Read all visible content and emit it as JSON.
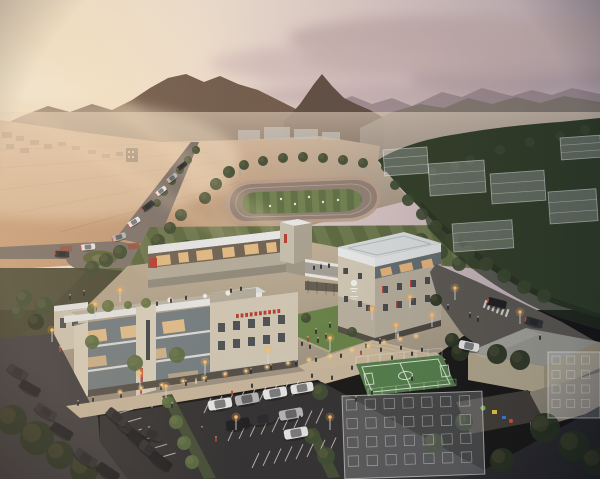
{
  "scene": {
    "type": "architectural-aerial-rendering",
    "time_of_day": "dusk",
    "description": "Aerial dusk rendering of a modern low-rise campus of three connected stone-and-glass buildings with a rooftop garden terrace, central courtyard lawn, futsal court, parking lot, roundabout boulevard, running-track field, translucent planned buildings, forested hills and sunset mountains"
  },
  "palette": {
    "mtn_left": "#6e5849",
    "mtn_dark": "#5b4a40",
    "mtn_far": "#99878d",
    "mtn_mid": "#81776f",
    "forest": "#2a3823",
    "forest_dark": "#1f2b1b",
    "slope": "#41422e",
    "island": "#5a6138",
    "lawn": "#5e6c40",
    "lawn_dark": "#57653c",
    "lawn_light": "#67744a",
    "track": "#8d7d72",
    "track_line": "#c3b2a4",
    "field_dark": "#5a6d40",
    "field_light": "#6b7e4e",
    "loop": "#b69a87",
    "road": "#7a706a",
    "road_dark": "#6b625c",
    "right_road": "#56534e",
    "asphalt": "#39383c",
    "asphalt_dark": "#2b2b2e",
    "paving": "#b6a98f",
    "paving_light": "#c9b89c",
    "walkway": "#b3a48d",
    "sidewalk": "#c6b69d",
    "stone": "#cfc7b5",
    "stone_bright": "#d8d0bd",
    "stone_shade": "#b1aa9a",
    "stone_dark": "#9b9486",
    "base_dark": "#4e4a44",
    "metal": "#e6e8e9",
    "roof": "#d7dcde",
    "roof2": "#cfd5d8",
    "band": "#dde1e4",
    "glass": "#6e7a80",
    "glass_dark": "#5d686d",
    "glassb1": "#6b5f52",
    "lit": "#f6c98c",
    "lit2": "#f0b87a",
    "accent": "#b23a2e",
    "tail": "#e8452f",
    "court": "#4e7c47",
    "court_line": "#e9efe7",
    "tree_dark": "#232e1d",
    "tree_mid": "#39482e",
    "tree_bright": "#53683d",
    "tree_warm": "#5e7040",
    "car_white": "#e9eaea",
    "car_silver": "#b4b7b9",
    "car_dark": "#2a2c30",
    "car_black": "#17191c",
    "people": "#26282c",
    "people_light": "#cfcac2",
    "glow": "#ffc070",
    "bollard": "#ffcf8a",
    "hip_wall": "#b0a68c",
    "hip_wall2": "#9c9278",
    "hip_roof": "#97978f",
    "town_bldg": "#8f6f58",
    "complex": "#a9aeb0"
  },
  "objects": {
    "town": [
      [
        2,
        132,
        10,
        6
      ],
      [
        16,
        136,
        8,
        5
      ],
      [
        30,
        140,
        9,
        5
      ],
      [
        44,
        144,
        8,
        5
      ],
      [
        6,
        144,
        8,
        5
      ],
      [
        20,
        148,
        9,
        5
      ],
      [
        58,
        142,
        8,
        4
      ],
      [
        72,
        146,
        8,
        4
      ],
      [
        88,
        150,
        8,
        4
      ],
      [
        102,
        154,
        8,
        4
      ],
      [
        116,
        152,
        7,
        4
      ]
    ],
    "ghost_boxes": [
      [
        383,
        150,
        44,
        26
      ],
      [
        428,
        164,
        56,
        32
      ],
      [
        490,
        174,
        54,
        30
      ],
      [
        548,
        192,
        48,
        32
      ],
      [
        452,
        224,
        60,
        28
      ],
      [
        560,
        138,
        40,
        22
      ]
    ],
    "ghost_grids": [
      [
        342,
        396,
        140,
        83,
        7,
        4,
        -2
      ],
      [
        548,
        352,
        52,
        66,
        3,
        4,
        0
      ]
    ],
    "trees_bg": [
      [
        24,
        298,
        8,
        "tree_mid"
      ],
      [
        44,
        306,
        9,
        "tree_mid"
      ],
      [
        64,
        314,
        8,
        "tree_mid"
      ],
      [
        84,
        322,
        8,
        "tree_mid"
      ],
      [
        102,
        330,
        8,
        "tree_mid"
      ],
      [
        36,
        322,
        8,
        "tree_dark"
      ],
      [
        58,
        332,
        9,
        "tree_dark"
      ],
      [
        80,
        342,
        8,
        "tree_dark"
      ],
      [
        18,
        312,
        7,
        "tree_mid"
      ],
      [
        98,
        348,
        7,
        "tree_dark"
      ],
      [
        112,
        338,
        7,
        "tree_dark"
      ],
      [
        205,
        198,
        6,
        "tree_mid"
      ],
      [
        216,
        184,
        6,
        "tree_mid"
      ],
      [
        229,
        172,
        6,
        "tree_mid"
      ],
      [
        244,
        165,
        5,
        "tree_mid"
      ],
      [
        263,
        161,
        5,
        "tree_mid"
      ],
      [
        283,
        158,
        5,
        "tree_mid"
      ],
      [
        303,
        157,
        5,
        "tree_mid"
      ],
      [
        323,
        158,
        5,
        "tree_mid"
      ],
      [
        343,
        160,
        5,
        "tree_mid"
      ],
      [
        363,
        163,
        5,
        "tree_mid"
      ],
      [
        386,
        167,
        5,
        "tree_mid"
      ],
      [
        405,
        172,
        6,
        "tree_mid"
      ],
      [
        417,
        182,
        6,
        "tree_mid"
      ],
      [
        427,
        194,
        6,
        "tree_mid"
      ],
      [
        181,
        215,
        6,
        "tree_mid"
      ],
      [
        170,
        228,
        6,
        "tree_mid"
      ],
      [
        158,
        241,
        7,
        "tree_mid"
      ],
      [
        187,
        246,
        6,
        "tree_mid"
      ],
      [
        200,
        255,
        6,
        "tree_mid"
      ],
      [
        421,
        240,
        7,
        "tree_mid"
      ],
      [
        441,
        252,
        7,
        "tree_mid"
      ],
      [
        459,
        264,
        7,
        "tree_mid"
      ],
      [
        120,
        252,
        7,
        "tree_mid"
      ],
      [
        106,
        260,
        7,
        "tree_mid"
      ],
      [
        92,
        268,
        7,
        "tree_mid"
      ],
      [
        196,
        150,
        4,
        "tree_mid"
      ],
      [
        188,
        160,
        4,
        "tree_mid"
      ],
      [
        180,
        170,
        4,
        "tree_mid"
      ],
      [
        172,
        181,
        4,
        "tree_mid"
      ],
      [
        164,
        192,
        4,
        "tree_mid"
      ],
      [
        157,
        203,
        4,
        "tree_mid"
      ],
      [
        452,
        286,
        6,
        "tree_mid"
      ],
      [
        470,
        296,
        7,
        "tree_mid"
      ],
      [
        488,
        306,
        7,
        "tree_mid"
      ],
      [
        506,
        316,
        7,
        "tree_mid"
      ],
      [
        524,
        326,
        7,
        "tree_mid"
      ]
    ],
    "trees_fg": [
      [
        12,
        420,
        15,
        "tree_dark"
      ],
      [
        37,
        438,
        17,
        "tree_dark"
      ],
      [
        60,
        455,
        14,
        "tree_dark"
      ],
      [
        84,
        470,
        14,
        "tree_dark"
      ],
      [
        135,
        363,
        8,
        "tree_bright"
      ],
      [
        177,
        355,
        8,
        "tree_bright"
      ],
      [
        92,
        342,
        7,
        "tree_bright"
      ],
      [
        320,
        392,
        8,
        "tree_mid"
      ],
      [
        168,
        402,
        6,
        "tree_bright"
      ],
      [
        176,
        422,
        7,
        "tree_bright"
      ],
      [
        184,
        443,
        7,
        "tree_bright"
      ],
      [
        192,
        462,
        7,
        "tree_bright"
      ],
      [
        312,
        436,
        8,
        "tree_mid"
      ],
      [
        326,
        456,
        9,
        "tree_mid"
      ],
      [
        460,
        352,
        9,
        "tree_dark"
      ],
      [
        497,
        354,
        10,
        "tree_dark"
      ],
      [
        520,
        360,
        10,
        "tree_dark"
      ],
      [
        545,
        428,
        15,
        "tree_dark"
      ],
      [
        574,
        446,
        16,
        "tree_dark"
      ],
      [
        596,
        462,
        14,
        "tree_dark"
      ],
      [
        502,
        460,
        12,
        "tree_dark"
      ],
      [
        464,
        422,
        9,
        "tree_dark"
      ],
      [
        434,
        443,
        10,
        "tree_dark"
      ],
      [
        92,
        309,
        5,
        "tree_warm"
      ],
      [
        108,
        306,
        6,
        "tree_warm"
      ],
      [
        146,
        303,
        5,
        "tree_warm"
      ],
      [
        128,
        305,
        4,
        "tree_warm"
      ],
      [
        306,
        318,
        5,
        "tree_mid"
      ],
      [
        352,
        332,
        5,
        "tree_mid"
      ],
      [
        436,
        300,
        6,
        "tree_dark"
      ],
      [
        452,
        340,
        7,
        "tree_dark"
      ]
    ],
    "cars": [
      [
        220,
        404,
        -10,
        1,
        "car_white",
        0
      ],
      [
        247,
        399,
        -10,
        1,
        "car_silver",
        0
      ],
      [
        275,
        393,
        -10,
        1,
        "car_white",
        0
      ],
      [
        302,
        388,
        -10,
        0.95,
        "car_white",
        0
      ],
      [
        238,
        424,
        -10,
        1,
        "car_black",
        0
      ],
      [
        263,
        419,
        -10,
        1,
        "car_dark",
        0
      ],
      [
        291,
        414,
        -10,
        1,
        "car_silver",
        0
      ],
      [
        296,
        433,
        -10,
        1,
        "car_white",
        0
      ],
      [
        128,
        428,
        38,
        1,
        "car_dark",
        0
      ],
      [
        139,
        439,
        38,
        1,
        "car_black",
        0
      ],
      [
        150,
        450,
        38,
        1,
        "car_dark",
        0
      ],
      [
        161,
        461,
        38,
        1,
        "car_black",
        0
      ],
      [
        117,
        417,
        38,
        0.95,
        "car_dark",
        0
      ],
      [
        18,
        372,
        30,
        0.9,
        "car_dark",
        0
      ],
      [
        30,
        388,
        30,
        0.9,
        "car_black",
        0
      ],
      [
        46,
        412,
        32,
        0.95,
        "car_dark",
        0
      ],
      [
        62,
        431,
        32,
        0.95,
        "car_black",
        0
      ],
      [
        86,
        458,
        34,
        1,
        "car_dark",
        0
      ],
      [
        108,
        472,
        34,
        1,
        "car_black",
        0
      ],
      [
        152,
        434,
        22,
        0.95,
        "car_dark",
        0
      ],
      [
        88,
        247,
        -6,
        0.6,
        "car_white",
        1
      ],
      [
        62,
        254,
        4,
        0.6,
        "car_dark",
        1
      ],
      [
        119,
        237,
        -18,
        0.6,
        "car_silver",
        1
      ],
      [
        134,
        222,
        -32,
        0.55,
        "car_white",
        1
      ],
      [
        148,
        206,
        -38,
        0.55,
        "car_dark",
        1
      ],
      [
        161,
        191,
        -38,
        0.5,
        "car_white",
        1
      ],
      [
        172,
        178,
        -38,
        0.5,
        "car_silver",
        1
      ],
      [
        182,
        166,
        -38,
        0.45,
        "car_dark",
        1
      ],
      [
        497,
        303,
        14,
        0.8,
        "car_black",
        1
      ],
      [
        469,
        346,
        12,
        0.85,
        "car_white",
        0
      ],
      [
        534,
        322,
        16,
        0.75,
        "car_dark",
        1
      ]
    ],
    "people": [
      [
        78,
        406
      ],
      [
        93,
        402
      ],
      [
        121,
        398
      ],
      [
        141,
        394,
        "accent"
      ],
      [
        161,
        390
      ],
      [
        186,
        386
      ],
      [
        206,
        382
      ],
      [
        226,
        378,
        "accent"
      ],
      [
        251,
        374
      ],
      [
        271,
        370
      ],
      [
        296,
        366
      ],
      [
        316,
        362
      ],
      [
        341,
        358
      ],
      [
        361,
        355,
        "accent"
      ],
      [
        381,
        352
      ],
      [
        401,
        350
      ],
      [
        152,
        412
      ],
      [
        172,
        408
      ],
      [
        252,
        388
      ],
      [
        312,
        378
      ],
      [
        232,
        395,
        "accent"
      ],
      [
        352,
        370
      ],
      [
        332,
        380
      ],
      [
        392,
        360
      ],
      [
        412,
        356
      ],
      [
        422,
        352
      ],
      [
        302,
        346
      ],
      [
        310,
        349
      ],
      [
        318,
        343
      ],
      [
        326,
        339
      ],
      [
        316,
        334
      ],
      [
        308,
        342,
        "accent"
      ],
      [
        330,
        328
      ],
      [
        314,
        270
      ],
      [
        321,
        269
      ],
      [
        329,
        268
      ],
      [
        157,
        306
      ],
      [
        171,
        303
      ],
      [
        186,
        300
      ],
      [
        231,
        293
      ],
      [
        241,
        291
      ],
      [
        202,
        432
      ],
      [
        216,
        442,
        "accent"
      ],
      [
        356,
        402
      ],
      [
        372,
        395
      ],
      [
        412,
        381
      ],
      [
        300,
        420
      ],
      [
        70,
        300
      ],
      [
        84,
        296
      ],
      [
        60,
        352,
        "accent"
      ],
      [
        470,
        318
      ],
      [
        478,
        322
      ],
      [
        540,
        340
      ],
      [
        448,
        310
      ],
      [
        380,
        344
      ],
      [
        366,
        348
      ],
      [
        398,
        338,
        "people_light"
      ],
      [
        285,
        360,
        "people_light"
      ],
      [
        196,
        384,
        "people_light"
      ]
    ],
    "players": [
      [
        281,
        199
      ],
      [
        295,
        204
      ],
      [
        309,
        197
      ],
      [
        323,
        202
      ],
      [
        270,
        206
      ],
      [
        338,
        200
      ]
    ],
    "lights": [
      [
        95,
        318,
        14
      ],
      [
        140,
        387,
        14
      ],
      [
        205,
        375,
        13
      ],
      [
        268,
        363,
        13
      ],
      [
        330,
        351,
        13
      ],
      [
        396,
        338,
        13
      ],
      [
        432,
        327,
        12
      ],
      [
        455,
        300,
        12
      ],
      [
        520,
        324,
        12
      ],
      [
        166,
        398,
        12
      ],
      [
        236,
        430,
        13
      ],
      [
        330,
        430,
        13
      ],
      [
        52,
        342,
        12
      ],
      [
        120,
        302,
        12
      ],
      [
        410,
        308,
        11
      ],
      [
        372,
        320,
        11
      ]
    ],
    "bollards": [
      [
        120,
        392
      ],
      [
        141,
        388
      ],
      [
        162,
        385
      ],
      [
        183,
        381
      ],
      [
        204,
        378
      ],
      [
        225,
        374
      ],
      [
        246,
        371
      ],
      [
        267,
        367
      ],
      [
        288,
        363
      ],
      [
        309,
        360
      ],
      [
        330,
        356
      ],
      [
        352,
        350
      ],
      [
        368,
        346
      ],
      [
        384,
        342
      ],
      [
        400,
        339
      ],
      [
        416,
        336
      ]
    ],
    "stall_rows": [
      [
        204,
        413,
        9,
        11,
        -2.2,
        7,
        -15
      ],
      [
        228,
        441,
        9,
        11,
        -2.2,
        7,
        -15
      ],
      [
        252,
        468,
        8,
        11,
        -2.2,
        7,
        -15
      ],
      [
        116,
        414,
        6,
        8.5,
        8.8,
        17,
        -5
      ]
    ],
    "sign_blocks": {
      "x": 236,
      "y": 314,
      "n": 10,
      "dx": 4.6,
      "dy": -0.55,
      "w": 2.8,
      "h": 4
    }
  }
}
